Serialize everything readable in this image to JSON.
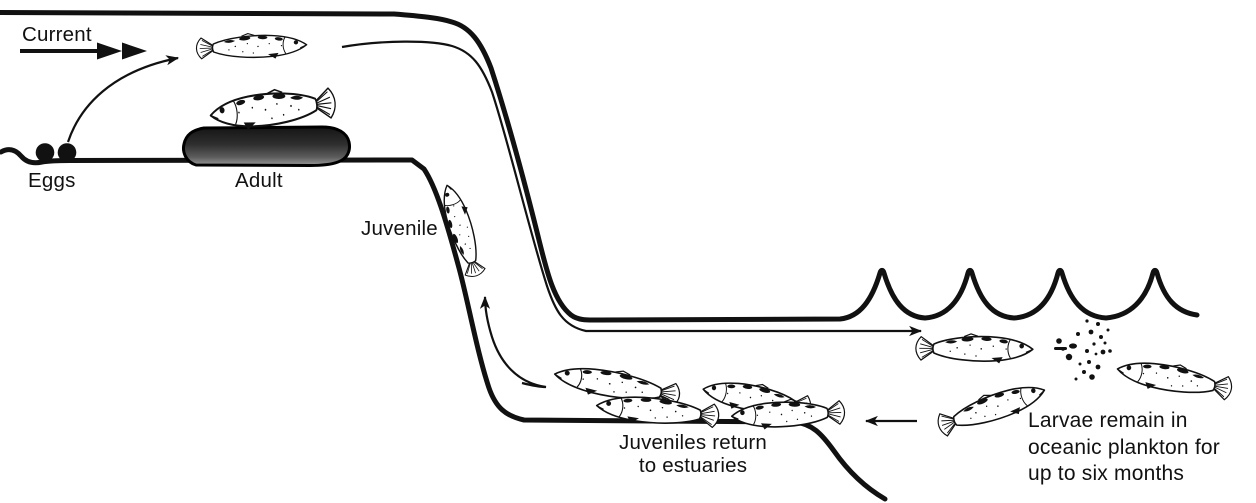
{
  "canvas": {
    "background": "#ffffff",
    "ink": "#111111",
    "rock_dark": "#151515",
    "rock_light": "#999999"
  },
  "labels": {
    "current": "Current",
    "eggs": "Eggs",
    "adult": "Adult",
    "juvenile": "Juvenile",
    "juveniles_return": [
      "Juveniles return",
      "to estuaries"
    ],
    "larvae_note": [
      "Larvae remain in",
      "oceanic plankton for",
      "up to six months"
    ]
  },
  "figures": {
    "egg_count": 2,
    "wave_crest_count": 4,
    "juvenile_school_count": 4,
    "ocean_larvae_count": 3
  }
}
